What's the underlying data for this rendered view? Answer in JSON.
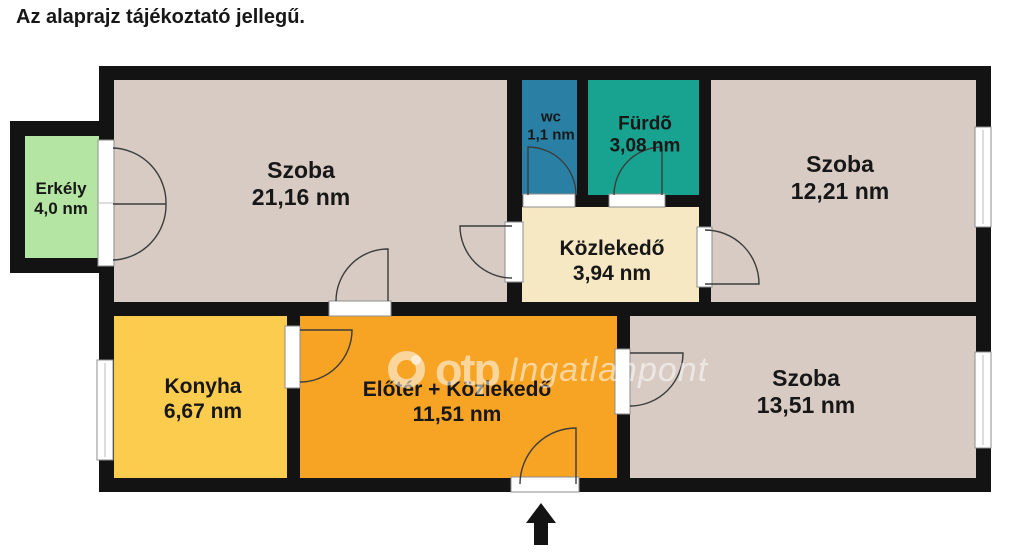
{
  "title": "Az alaprajz tájékoztató jellegű.",
  "watermark": {
    "brand": "otp",
    "name": "Ingatlanpont"
  },
  "colors": {
    "wall": "#131313",
    "arc": "#3c3c3c",
    "frame_fill": "#ffffff",
    "frame_stroke": "#8e8e8e",
    "background": "#ffffff"
  },
  "rooms": [
    {
      "name": "Erkély",
      "area": "4,0 nm",
      "color": "#b4e5a2"
    },
    {
      "name": "Szoba",
      "area": "21,16 nm",
      "color": "#d7cbc3"
    },
    {
      "name": "wc",
      "area": "1,1 nm",
      "color": "#2a80a4"
    },
    {
      "name": "Fürdõ",
      "area": "3,08 nm",
      "color": "#17a390"
    },
    {
      "name": "Szoba",
      "area": "12,21 nm",
      "color": "#d7cbc3"
    },
    {
      "name": "Közlekedő",
      "area": "3,94 nm",
      "color": "#f7e8c4"
    },
    {
      "name": "Konyha",
      "area": "6,67 nm",
      "color": "#fbcc4d"
    },
    {
      "name": "Előtér + Közlekedő",
      "area": "11,51 nm",
      "color": "#f7a424"
    },
    {
      "name": "Szoba",
      "area": "13,51 nm",
      "color": "#d7cbc3"
    }
  ]
}
